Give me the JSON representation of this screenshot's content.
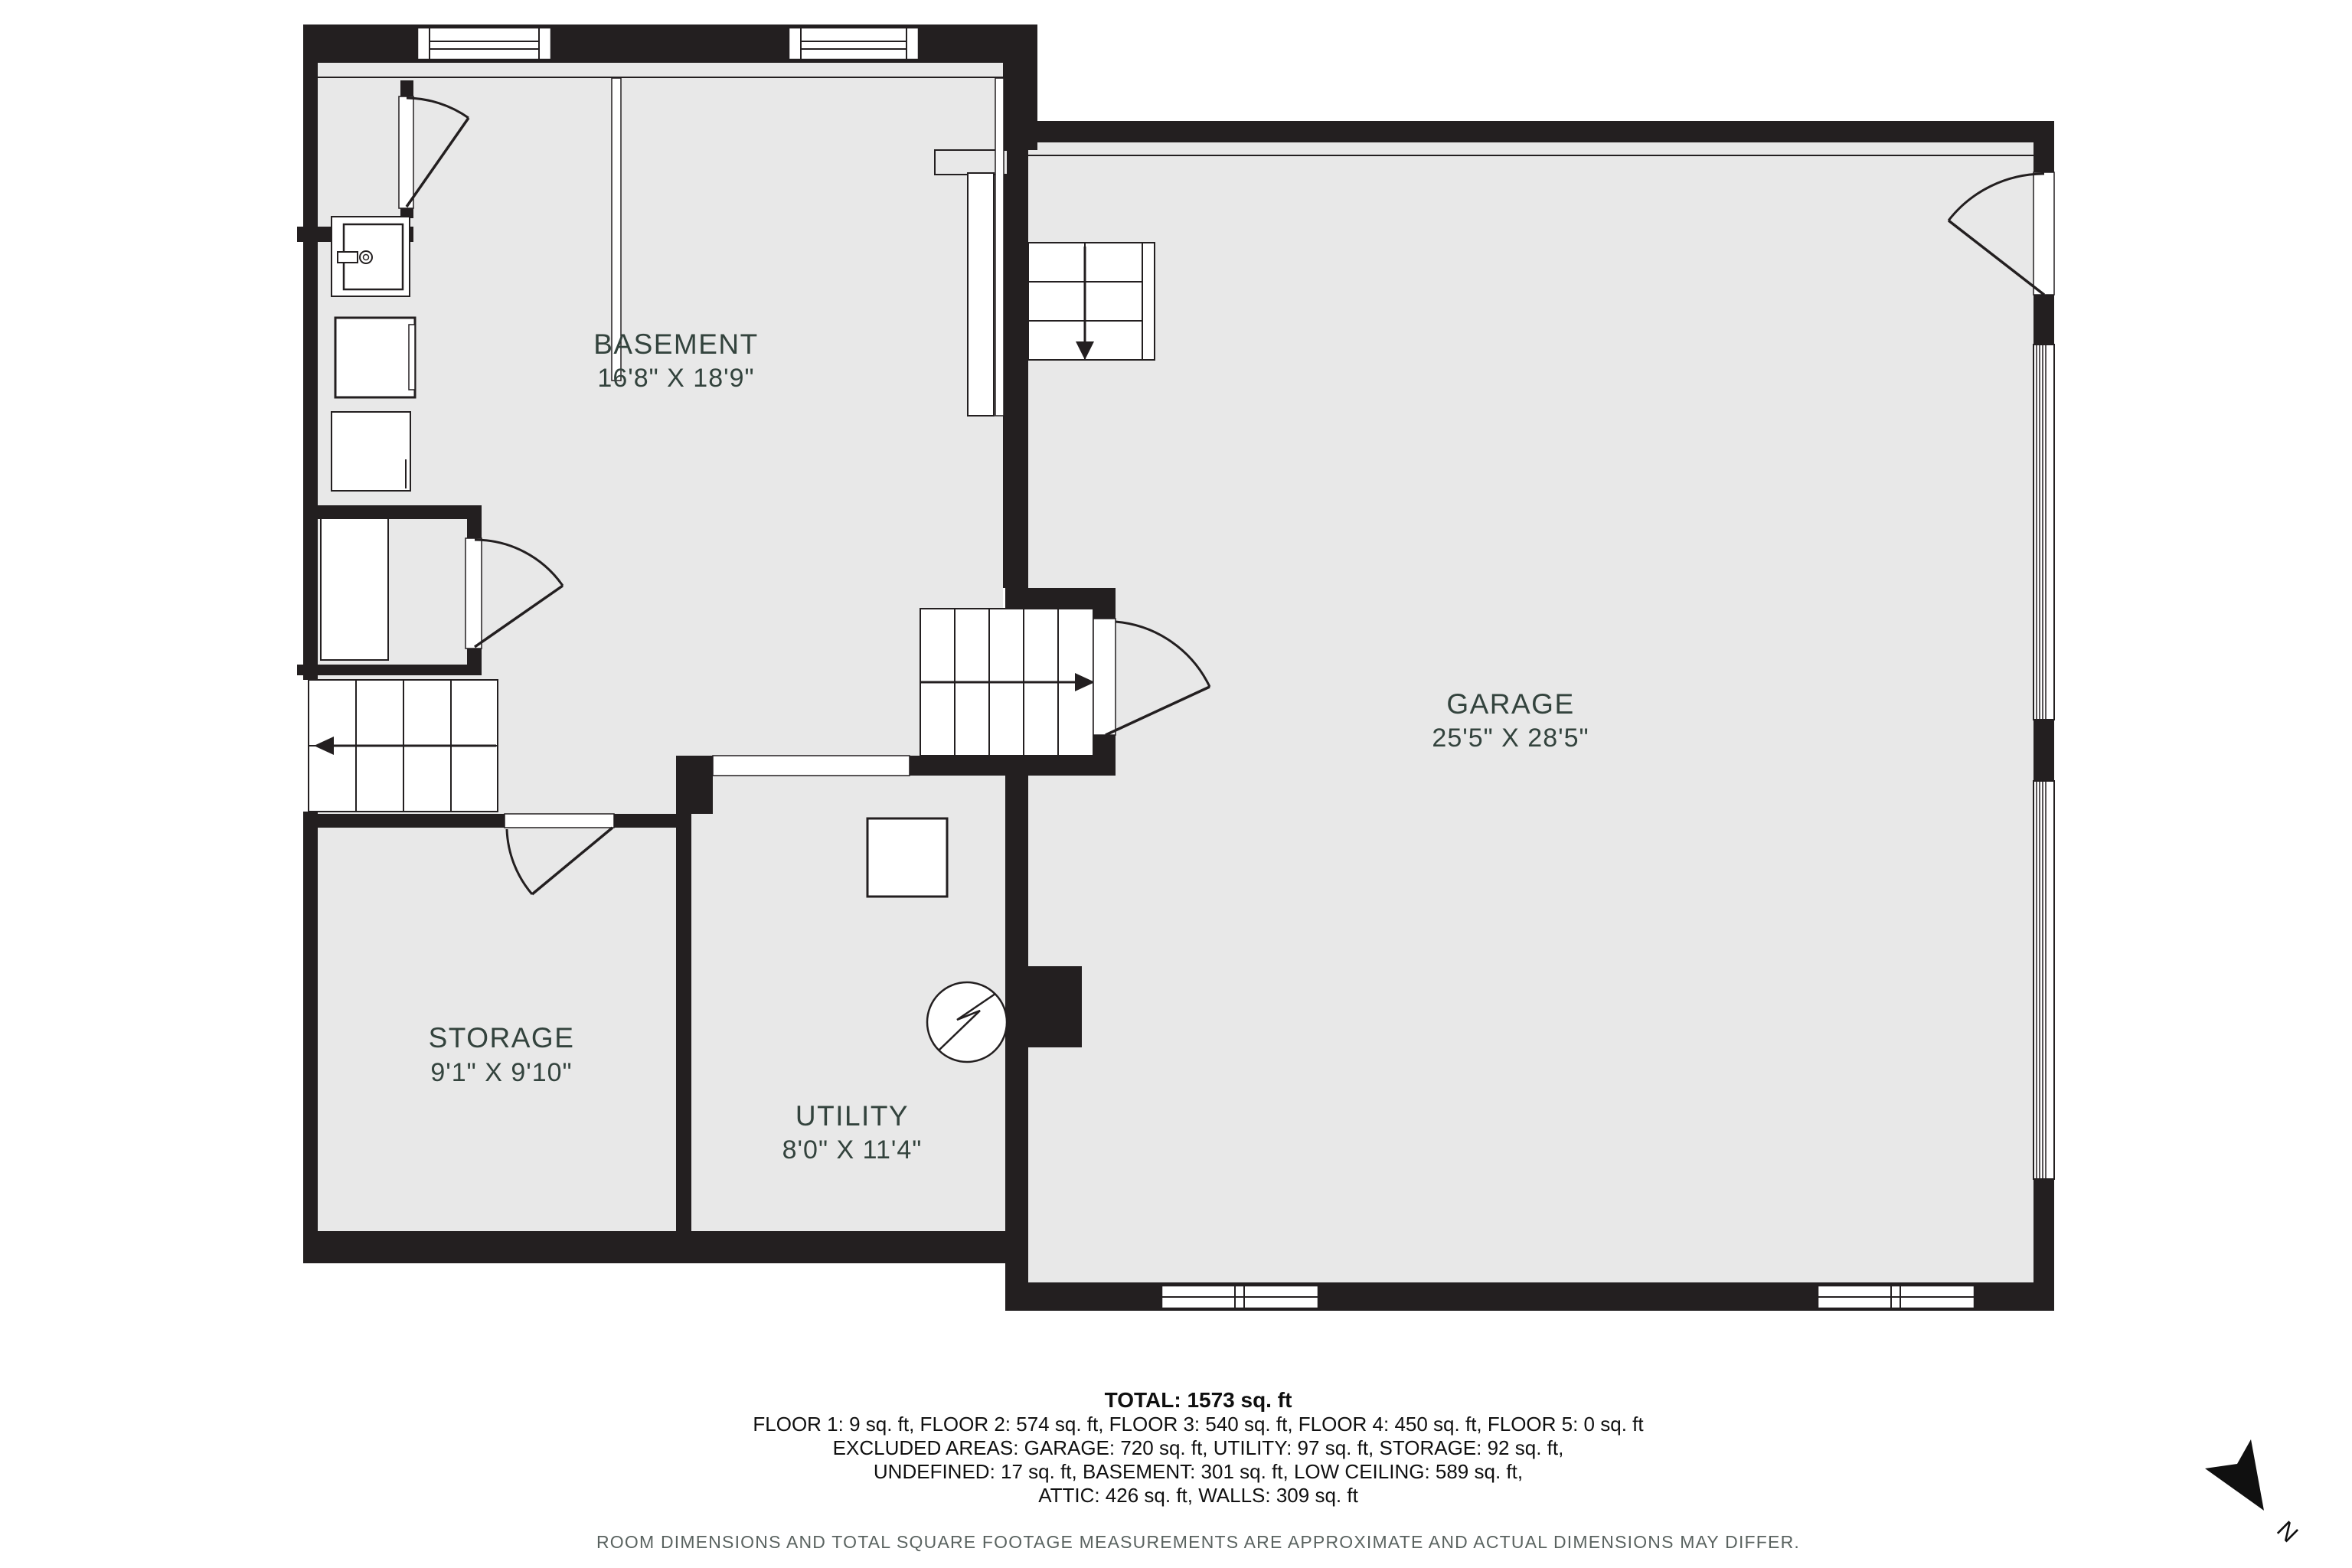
{
  "rooms": [
    {
      "id": "basement",
      "name": "BASEMENT",
      "dims": "16'8\" X 18'9\""
    },
    {
      "id": "garage",
      "name": "GARAGE",
      "dims": "25'5\" X 28'5\""
    },
    {
      "id": "storage",
      "name": "STORAGE",
      "dims": "9'1\" X 9'10\""
    },
    {
      "id": "utility",
      "name": "UTILITY",
      "dims": "8'0\" X 11'4\""
    }
  ],
  "summary": {
    "total": "TOTAL: 1573 sq. ft",
    "line1": "FLOOR 1: 9 sq. ft, FLOOR 2: 574 sq. ft, FLOOR 3: 540 sq. ft, FLOOR 4: 450 sq. ft, FLOOR 5: 0 sq. ft",
    "line2": "EXCLUDED AREAS: GARAGE: 720 sq. ft, UTILITY: 97 sq. ft, STORAGE: 92 sq. ft,",
    "line3": "UNDEFINED: 17 sq. ft, BASEMENT: 301 sq. ft, LOW CEILING: 589 sq. ft,",
    "line4": "ATTIC: 426 sq. ft, WALLS: 309 sq. ft"
  },
  "disclaimer": "ROOM DIMENSIONS AND TOTAL SQUARE FOOTAGE MEASUREMENTS ARE APPROXIMATE AND ACTUAL DIMENSIONS MAY DIFFER.",
  "compass": {
    "north_label": "N"
  },
  "colors": {
    "wall": "#231f20",
    "floor": "#e8e8e8",
    "label_text": "#33433d",
    "summary_text": "#101010",
    "disclaimer_text": "#5a6360"
  }
}
